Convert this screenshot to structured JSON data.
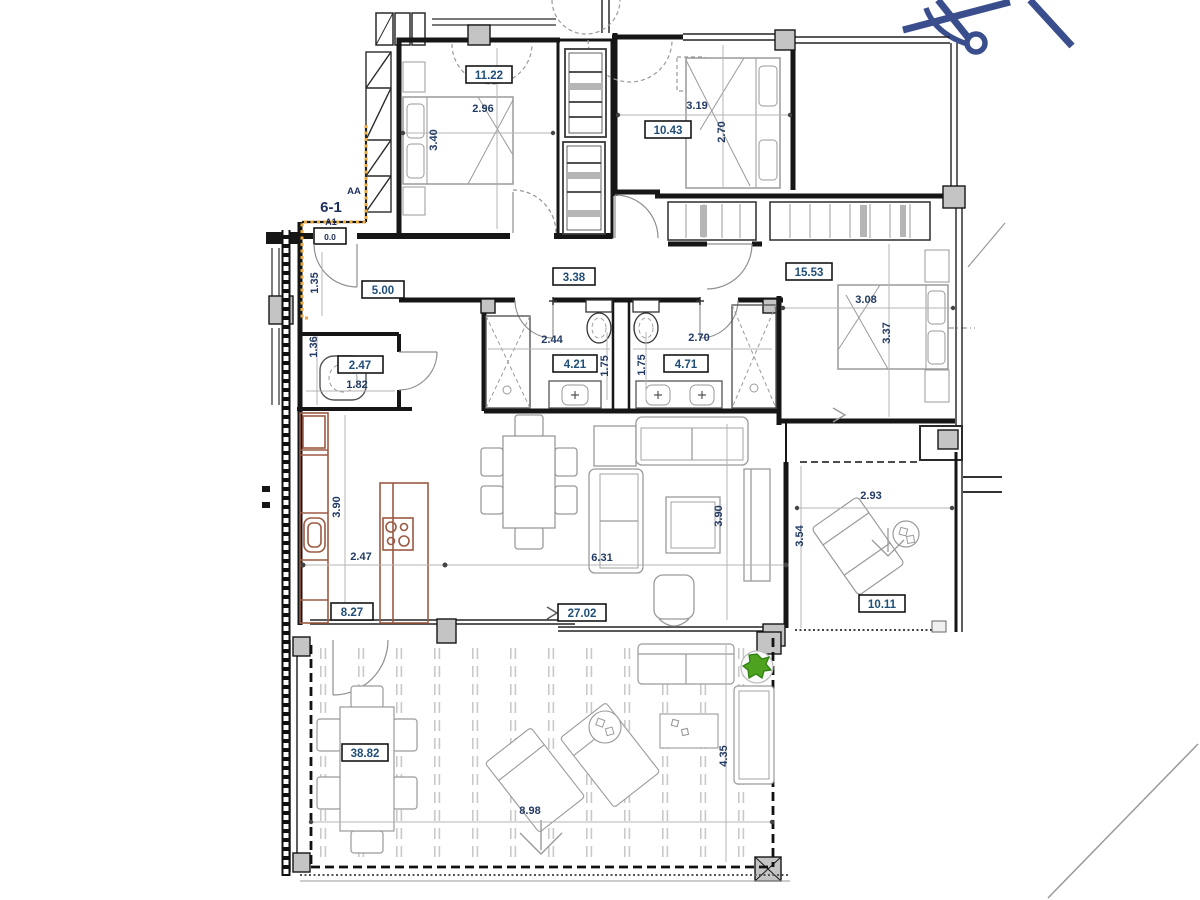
{
  "drawing": {
    "unit_marker": "6-1",
    "section_marker": "AA",
    "entry_ref": "A1",
    "entry_level": "0.0",
    "colors": {
      "label_navy": "#1f4e79",
      "dim_navy": "#223a63",
      "kitchen_brown": "#9b5a43",
      "boundary_orange": "#eaa93d",
      "north_arrow_blue": "#3a4d8c",
      "plant_green": "#4da31f"
    }
  },
  "labels": {
    "bedroom1_area": "11.22",
    "bedroom1_width": "2.96",
    "bedroom1_depth": "3.40",
    "bedroom2_area": "10.43",
    "bedroom2_width": "3.19",
    "bedroom2_depth": "2.70",
    "master_area": "15.53",
    "master_width": "3.08",
    "master_depth": "3.37",
    "hall_area": "5.00",
    "corridor_area": "3.38",
    "hall_width": "1.35",
    "bath1_area": "4.21",
    "bath1_width": "2.44",
    "bath1_depth": "1.75",
    "bath2_area": "4.71",
    "bath2_width": "2.70",
    "bath2_depth": "1.75",
    "wc_area": "2.47",
    "wc_width": "1.82",
    "wc_depth": "1.36",
    "kitchen_area": "8.27",
    "kitchen_width": "2.47",
    "kitchen_depth": "3.90",
    "living_area": "27.02",
    "living_width": "6.31",
    "living_depth": "3.90",
    "terrace_side_area": "10.11",
    "terrace_side_width": "2.93",
    "terrace_side_depth": "3.54",
    "terrace_main_area": "38.82",
    "terrace_main_width": "8.98",
    "terrace_main_depth": "4.35",
    "unit_marker": "6-1",
    "section_marker": "AA",
    "entry_ref": "A1",
    "entry_level": "0.0"
  }
}
